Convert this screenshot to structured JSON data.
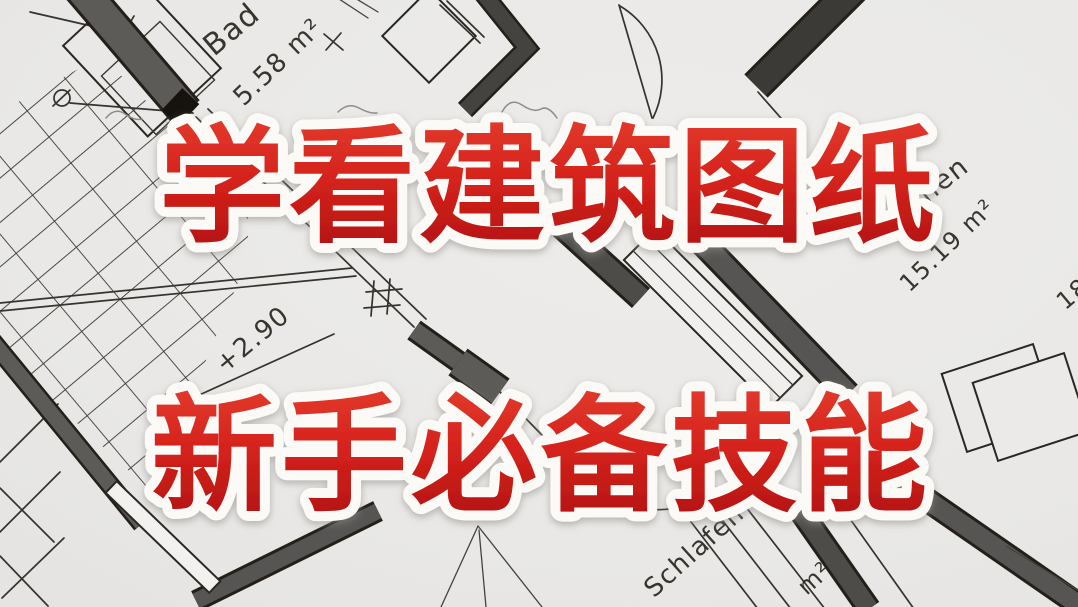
{
  "headline": {
    "line1": "学看建筑图纸",
    "line2": "新手必备技能",
    "text_color": "#d3201b",
    "text_color_top": "#e23a2c",
    "text_color_bottom": "#b01310",
    "outline_color": "#fbfaf7",
    "shadow_color": "#8f8c89"
  },
  "floor_plan": {
    "paper_color": "#e9e8e6",
    "ink_color": "#29251f",
    "wall_color": "#5d5b58",
    "labels": {
      "room1_name": "Bad",
      "room1_area": "5.58 m²",
      "room2_name": "Wohnen",
      "room2_area": "15.19 m²",
      "level_mark": "+2.90",
      "room3_name": "Schlafen",
      "room3_area": "m²",
      "edge_partial": "18"
    }
  }
}
